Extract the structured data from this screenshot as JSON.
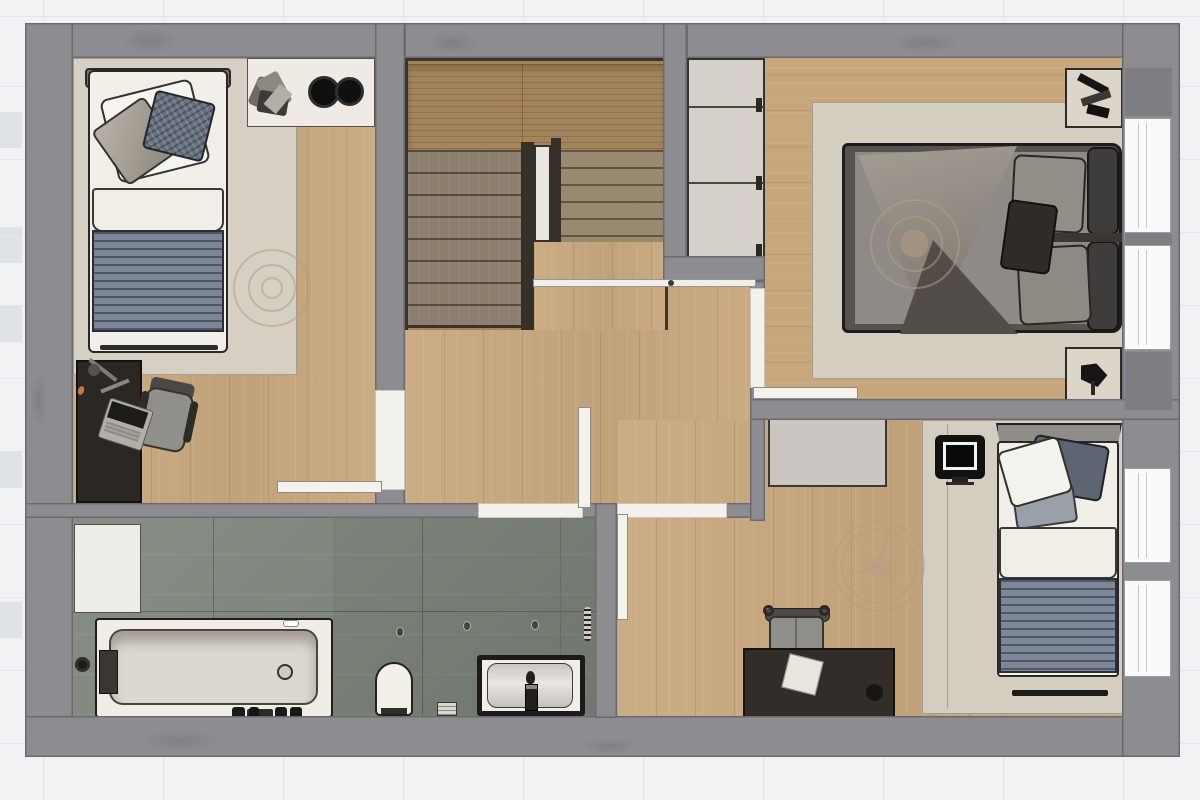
{
  "document": {
    "kind": "architectural floor plan",
    "view": "top-down 2D rendered plan",
    "floor": "upper floor with U-shaped staircase",
    "visible_text": []
  },
  "palette": {
    "background": "#f1f2f4",
    "grid_line": "#e1e4e8",
    "wall": "#8c8c91",
    "wall_pier_dark": "#7d7d83",
    "wood_floor": "#c9a87e",
    "stair_landing": "#a4845a",
    "stair_treads_left": "#8c7f6e",
    "stair_treads_right": "#99896e",
    "rug_beige": "#d6d0c4",
    "bathroom_tile": "#7f867c",
    "blanket_stripe_blue": "#7d8798",
    "dark_furniture": "#2e2a26",
    "white_fixture": "#f2efe9",
    "window": "#fafafa"
  },
  "rooms": {
    "bedroom1": {
      "name": "bedroom top-left",
      "furniture": [
        "single bed with white pillows and blue-gray striped blanket",
        "corner shelf with two round black speakers",
        "decorative plant",
        "dark desk with laptop and task lamp",
        "gray office chair",
        "concentric ceiling-light circles",
        "beige area rug",
        "door open into room"
      ]
    },
    "staircase": {
      "name": "U-shaped staircase",
      "parts": [
        "upper wood landing",
        "left flight of treads",
        "right flight of treads",
        "dark center divider rails with white slot",
        "white guard rail along hallway"
      ]
    },
    "master_bedroom": {
      "name": "master bedroom top-right",
      "furniture": [
        "double bed with crumpled gray duvet",
        "two gray pillows",
        "dark accent pillow",
        "two-cushion dark headboard",
        "two beige nightstands with black decor",
        "three-door wardrobe with handles",
        "concentric ceiling-light circles",
        "beige area rug",
        "door open against bottom wall"
      ]
    },
    "hallway": {
      "name": "central hallway",
      "furniture": [
        "oak flooring",
        "stair guard rail with end post"
      ]
    },
    "bathroom": {
      "name": "bathroom bottom-left",
      "furniture": [
        "bathtub with drain and black fittings",
        "black side knob",
        "toilet",
        "vanity with basin and faucet",
        "white storage cabinet",
        "small waste bin",
        "three floor spot drains",
        "tiny dashed wall strip"
      ]
    },
    "bedroom2": {
      "name": "bedroom bottom-right",
      "furniture": [
        "single bed with white pillow, dark pillow and striped blanket",
        "black TV on stand",
        "light gray dresser",
        "dark desk with paper sheet and black cup",
        "gray office chair with arm hooks",
        "ceiling fan with light",
        "beige area rug",
        "door open along left wall"
      ]
    }
  },
  "openings": {
    "windows_right_wall": 4,
    "doors": [
      "bedroom1 door swung into room near bottom wall",
      "bathroom door swung up into hallway",
      "bedroom2 door swung down along its left wall",
      "master bedroom door swung flat against bottom wall"
    ]
  }
}
